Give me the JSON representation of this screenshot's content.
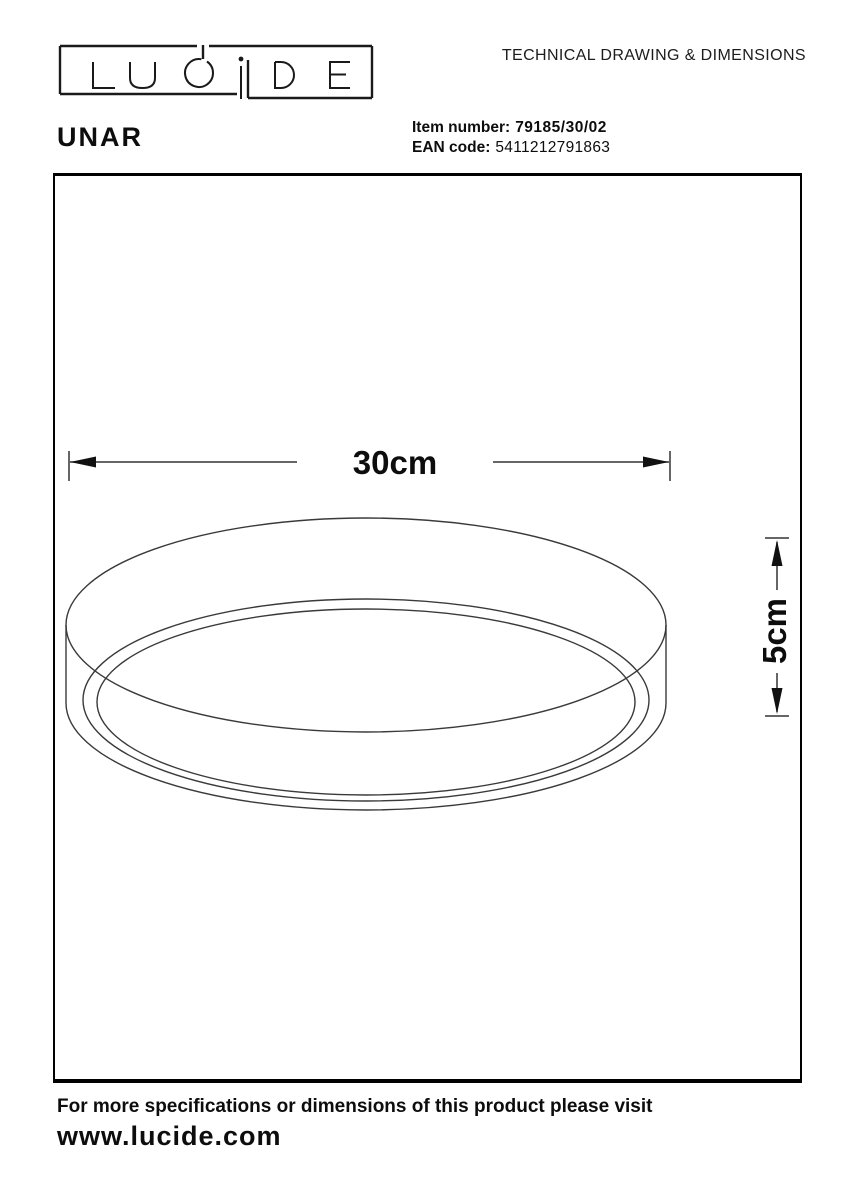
{
  "header": {
    "logo_text": "LUCIDE",
    "title": "TECHNICAL DRAWING & DIMENSIONS"
  },
  "product": {
    "name": "UNAR",
    "item_number_label": "Item number:",
    "item_number_value": "79185/30/02",
    "ean_label": "EAN code:",
    "ean_value": "5411212791863"
  },
  "drawing": {
    "subject": "round surface-mounted ceiling lamp, three-quarter view",
    "width_label": "30cm",
    "height_label": "5cm"
  },
  "footer": {
    "note": "For more specifications or dimensions of this product please visit",
    "website": "www.lucide.com"
  },
  "colors": {
    "background": "#ffffff",
    "ink": "#111111",
    "drawing_line": "#3a3a3a"
  }
}
